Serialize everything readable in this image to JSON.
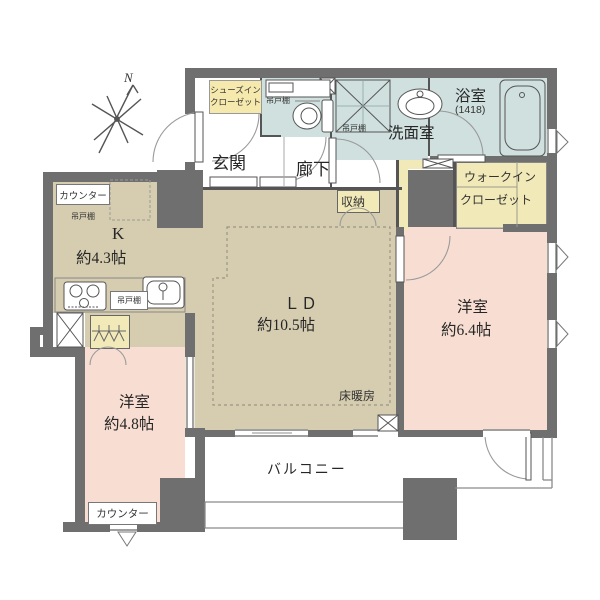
{
  "plan": {
    "compass_north": "N",
    "rooms": {
      "kitchen": {
        "name": "K",
        "size": "約4.3帖"
      },
      "living_dining": {
        "name": "ＬＤ",
        "size": "約10.5帖",
        "note": "床暖房"
      },
      "bedroom_east": {
        "name": "洋室",
        "size": "約6.4帖"
      },
      "bedroom_south": {
        "name": "洋室",
        "size": "約4.8帖"
      },
      "entrance": {
        "name": "玄関"
      },
      "corridor": {
        "name": "廊下"
      },
      "washroom": {
        "name": "洗面室"
      },
      "bathroom": {
        "name": "浴室",
        "size": "(1418)"
      },
      "balcony": {
        "name": "バルコニー"
      }
    },
    "storage": {
      "closet": {
        "name": "収納"
      },
      "walk_in_closet": {
        "line1": "ウォークイン",
        "line2": "クローゼット"
      },
      "shoes_in_closet": {
        "line1": "シューズイン",
        "line2": "クローゼット"
      }
    },
    "labels": {
      "hanging_cupboard": "吊戸棚",
      "counter": "カウンター"
    },
    "colors": {
      "wall": "#6f6f6f",
      "living_area": "#d6cdb0",
      "bedroom": "#f8ded2",
      "wet_area": "#cfe0de",
      "closet": "#f2e9b9",
      "label_box": "#f5e9ad"
    }
  }
}
